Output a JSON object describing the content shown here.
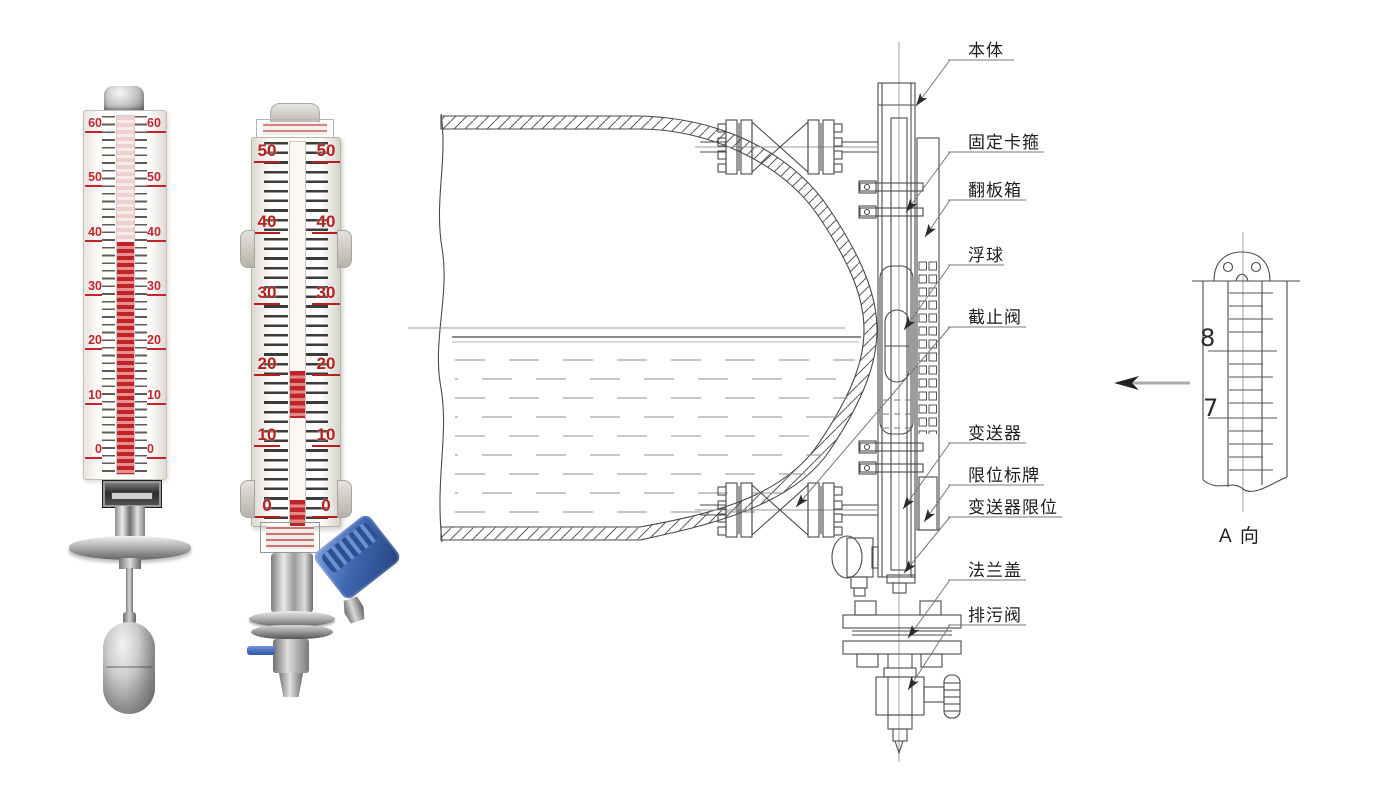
{
  "canvas": {
    "width": 1387,
    "height": 792,
    "background": "#ffffff"
  },
  "photos": {
    "gauge_basic": {
      "scale_values": [
        "60",
        "50",
        "40",
        "30",
        "20",
        "10",
        "0"
      ],
      "scale_color": "#c0262b",
      "filled_to_value": "40"
    },
    "gauge_with_transmitter": {
      "scale_values": [
        "50",
        "40",
        "30",
        "20",
        "10",
        "0"
      ],
      "scale_color": "#b5201f",
      "transmitter_color": "#4168b2"
    }
  },
  "diagram": {
    "part_labels": [
      "本体",
      "固定卡箍",
      "翻板箱",
      "浮球",
      "截止阀",
      "变送器",
      "限位标牌",
      "变送器限位",
      "法兰盖",
      "排污阀"
    ],
    "detail_view": {
      "tick_numbers": [
        "8",
        "7"
      ],
      "caption": "A 向"
    },
    "line_color": "#4a4a4a"
  }
}
